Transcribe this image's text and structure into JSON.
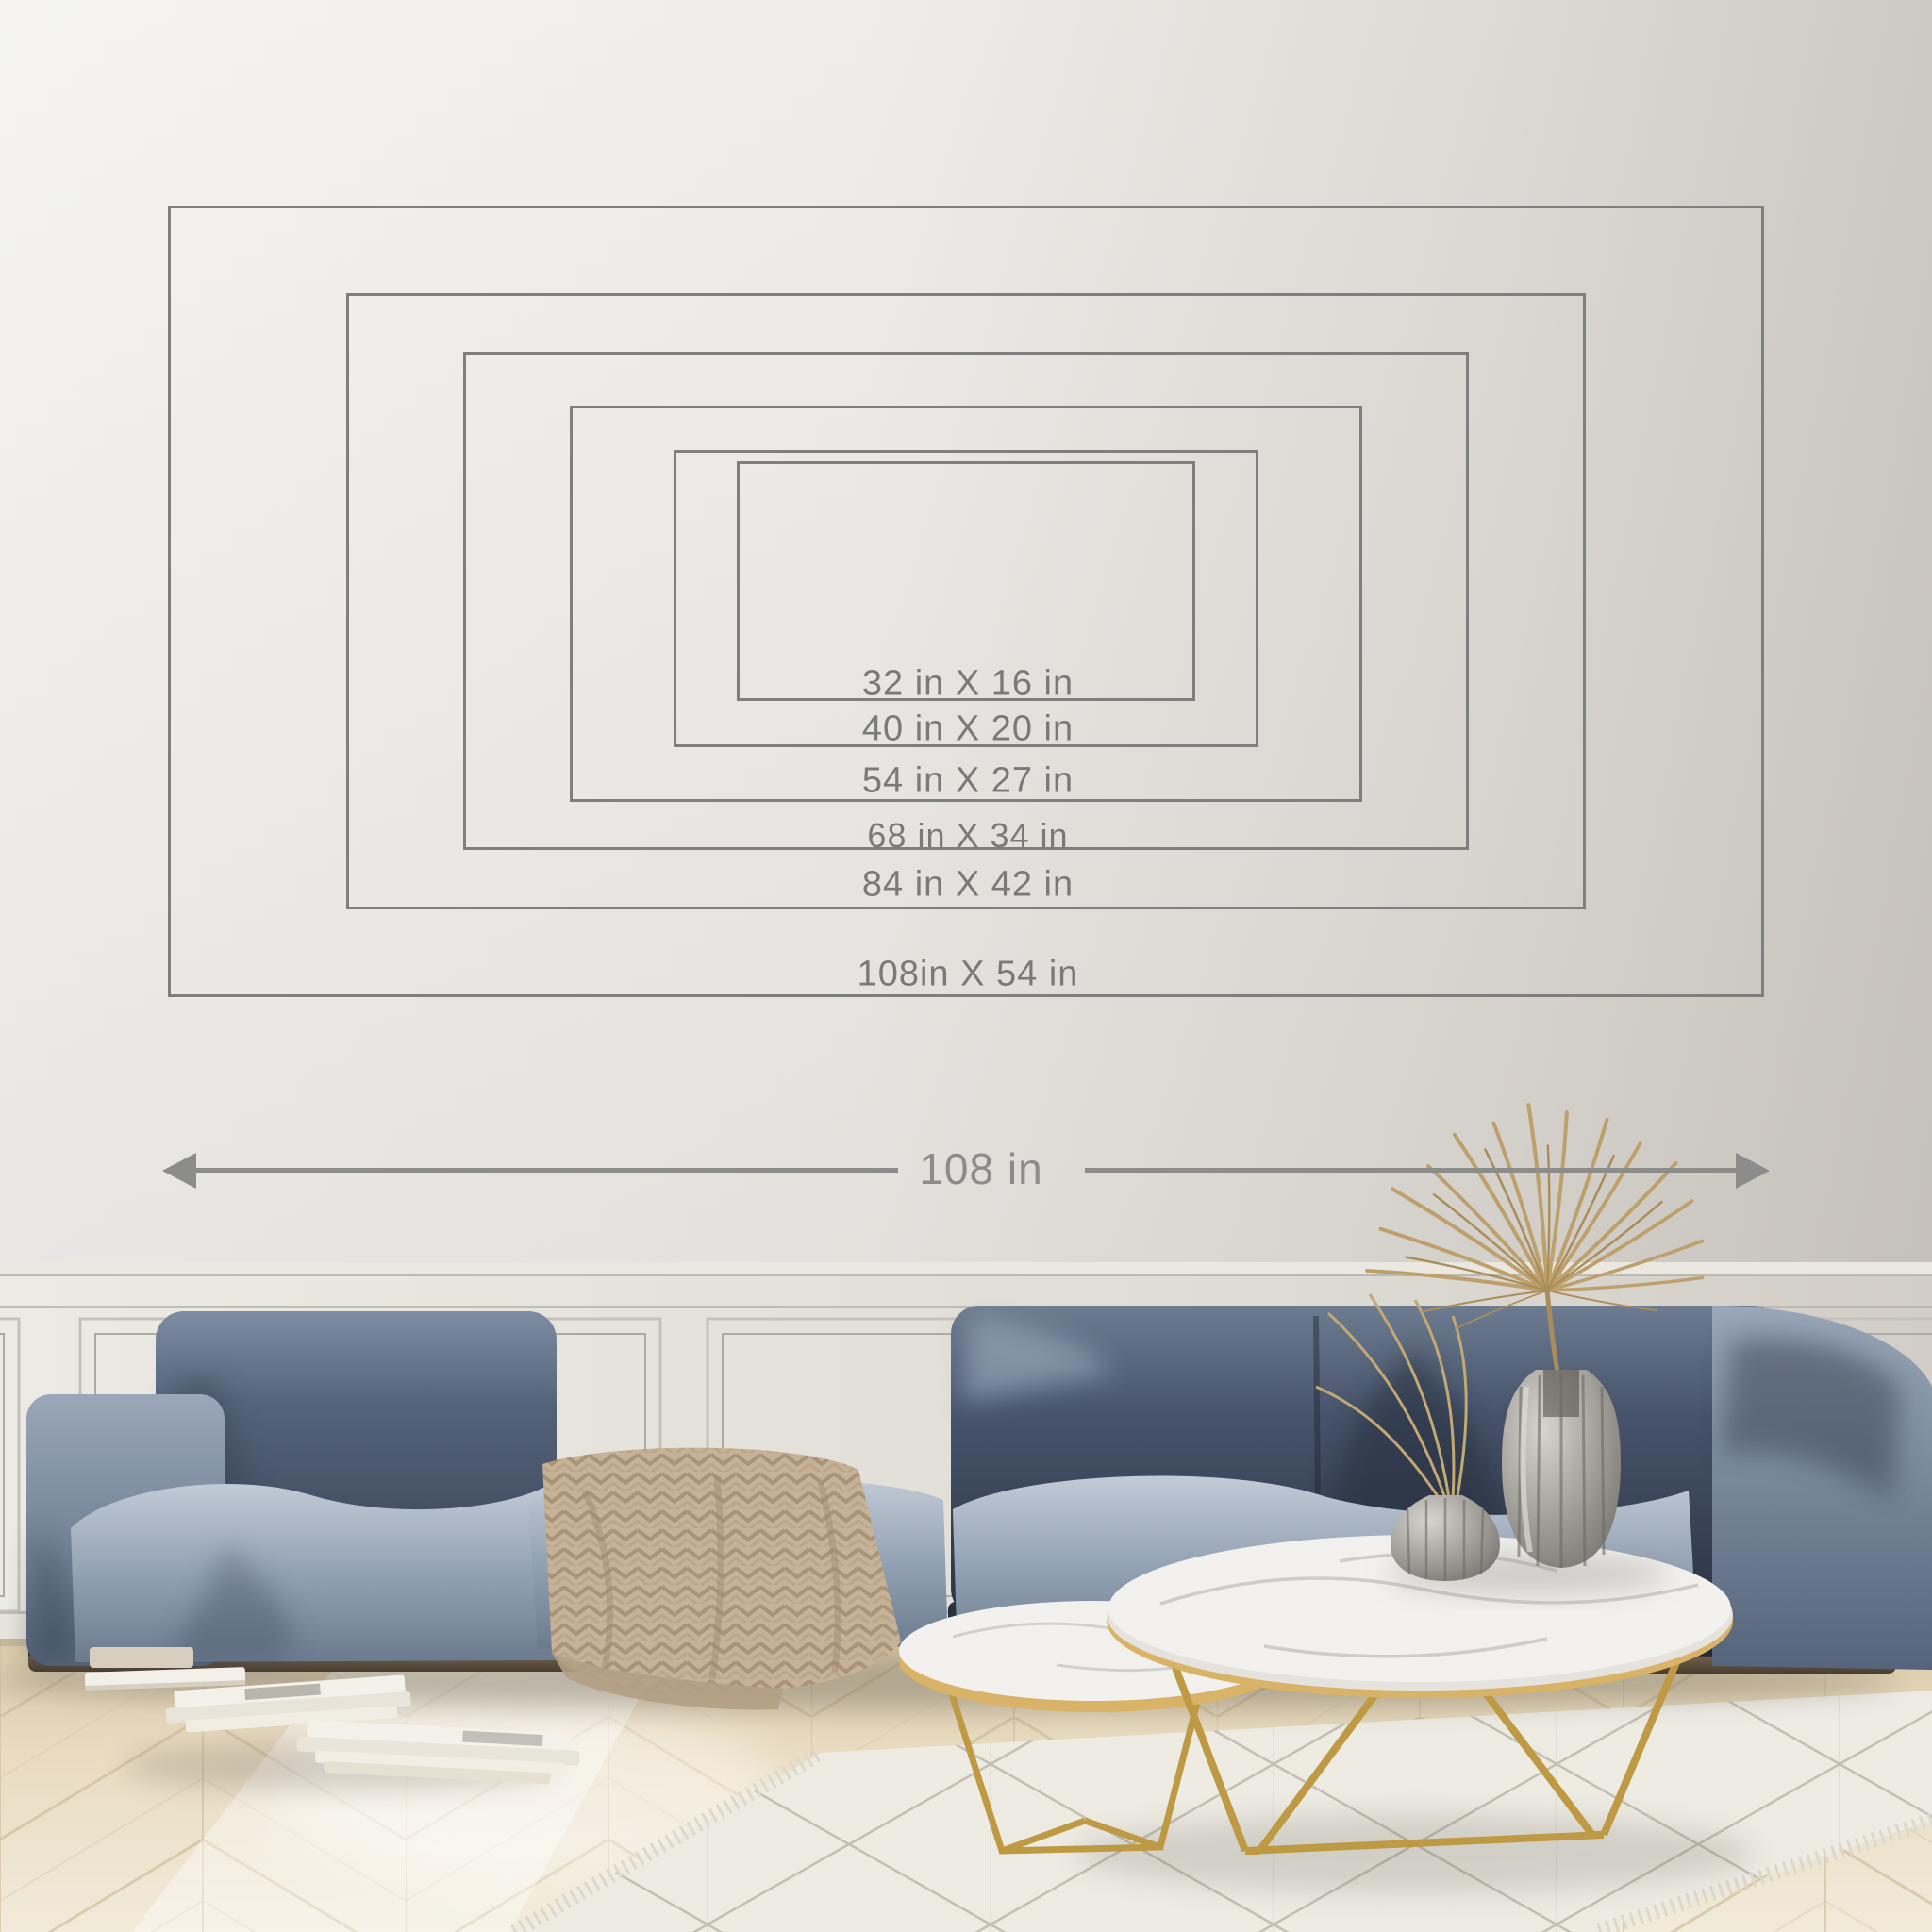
{
  "size_guide": {
    "unit": "in",
    "sizes": [
      {
        "label": "32 in X 16 in",
        "width_in": 32,
        "height_in": 16
      },
      {
        "label": "40 in X 20 in",
        "width_in": 40,
        "height_in": 20
      },
      {
        "label": "54 in X 27 in",
        "width_in": 54,
        "height_in": 27
      },
      {
        "label": "68 in X 34 in",
        "width_in": 68,
        "height_in": 34
      },
      {
        "label": "84 in X 42 in",
        "width_in": 84,
        "height_in": 42
      },
      {
        "label": "108in X 54 in",
        "width_in": 108,
        "height_in": 54
      }
    ],
    "width_arrow": {
      "label": "108 in"
    },
    "line_color": "#7f7f7d",
    "label_color": "#7a7a78",
    "arrow_color": "#8c8c8a"
  },
  "scene": {
    "colors": {
      "wall_left": "#f5f4f2",
      "wall_right": "#cdc9c3",
      "wainscot": "#e3e0da",
      "floor_wood": "#ecdfc6",
      "rug": "#edebe2",
      "rug_pattern": "#a19b8e",
      "sofa_dark": "#39455a",
      "sofa_light": "#9fadbe",
      "blanket": "#c6b299",
      "marble": "#f3f1ee",
      "gold": "#bf9a45",
      "plant": "#bda06c",
      "glass_vase": "#9b9793",
      "books": "#f0ece2"
    }
  }
}
